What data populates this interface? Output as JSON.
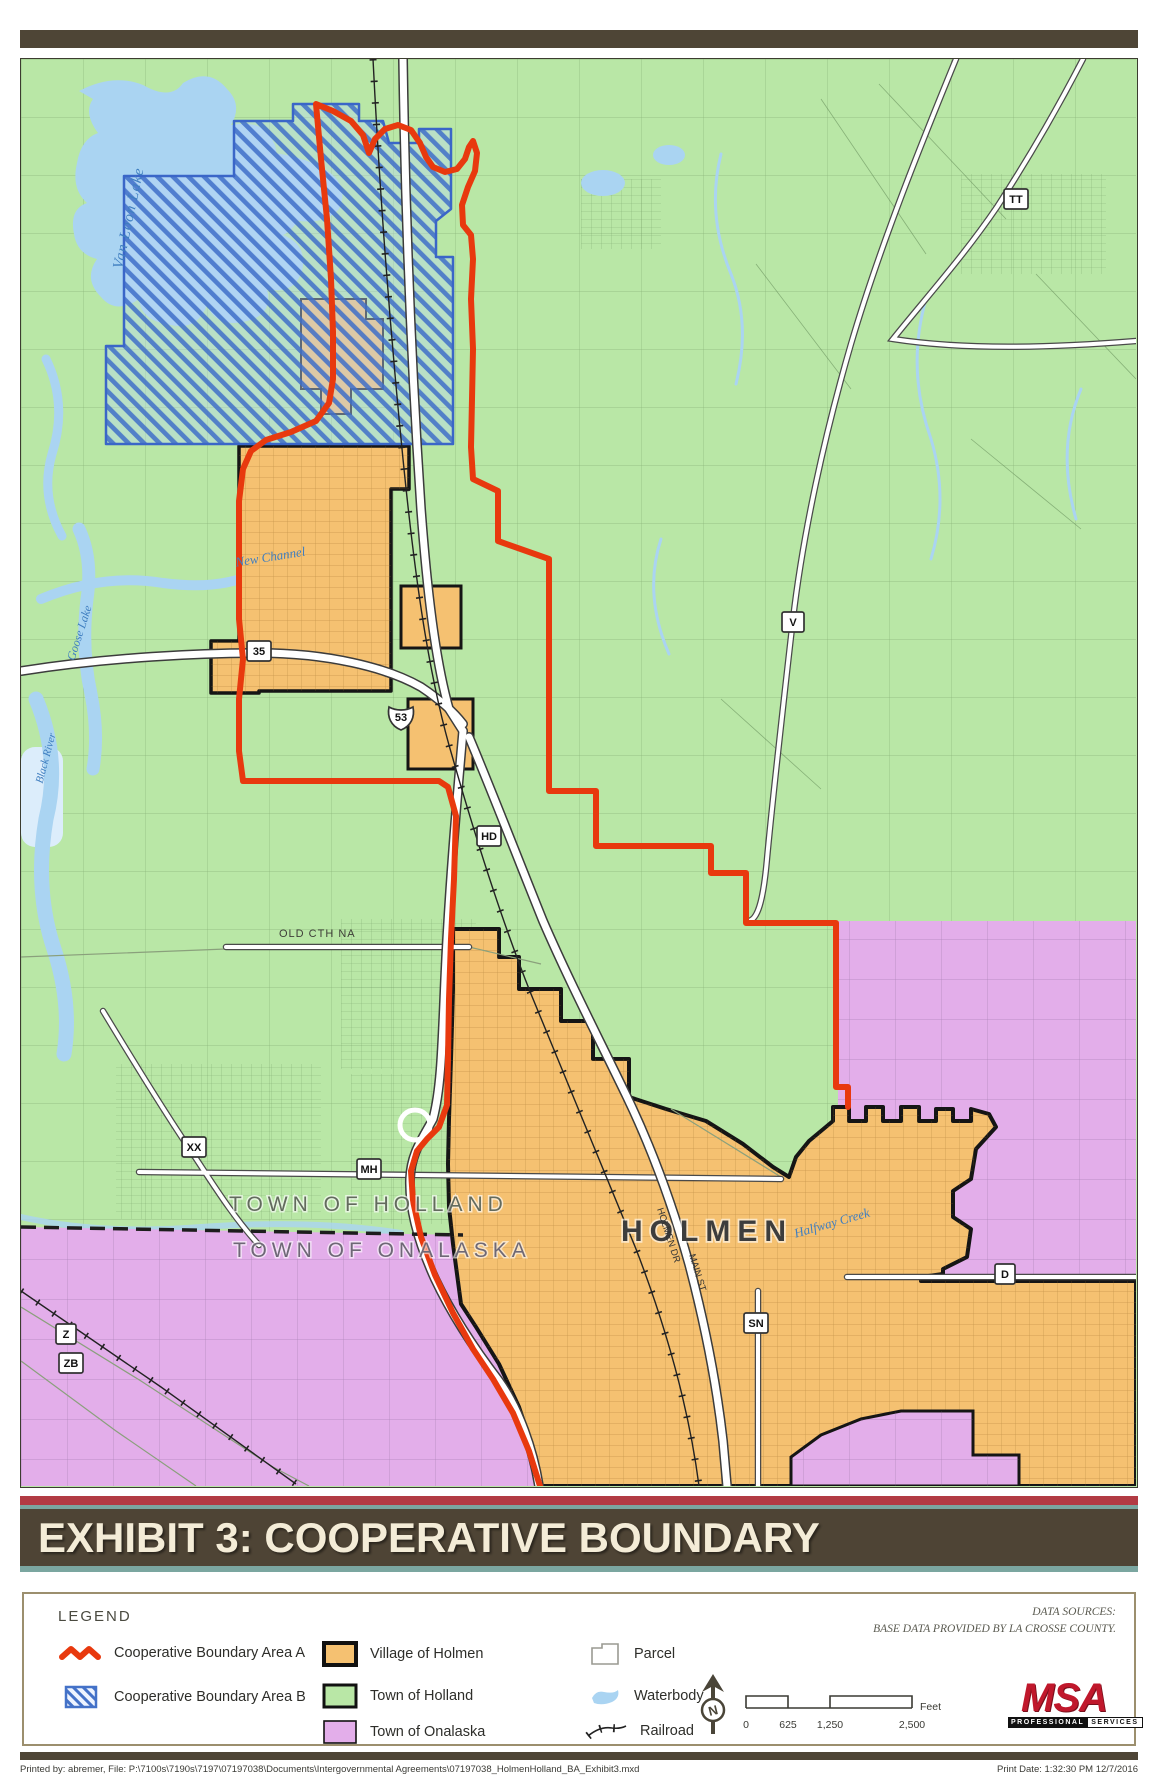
{
  "title": "EXHIBIT 3: COOPERATIVE BOUNDARY",
  "map": {
    "city_label": "HOLMEN",
    "town_labels": [
      "TOWN OF HOLLAND",
      "TOWN OF ONALASKA"
    ],
    "water_labels": [
      "Van Loon Lake",
      "Goose Lake",
      "Black River",
      "New Channel",
      "Halfway Creek"
    ],
    "street_labels": [
      "OLD CTH NA",
      "HOLMEN DR",
      "MAIN ST"
    ],
    "shields": [
      "35",
      "53",
      "HD",
      "V",
      "TT",
      "XX",
      "MH",
      "D",
      "SN",
      "Z",
      "ZB"
    ]
  },
  "legend": {
    "heading": "LEGEND",
    "items": {
      "area_a": "Cooperative Boundary Area A",
      "area_b": "Cooperative Boundary Area B",
      "holmen": "Village of Holmen",
      "holland": "Town of Holland",
      "onalaska": "Town of Onalaska",
      "parcel": "Parcel",
      "waterbody": "Waterbody",
      "railroad": "Railroad"
    },
    "data_sources_line1": "DATA SOURCES:",
    "data_sources_line2": "BASE DATA PROVIDED BY LA CROSSE COUNTY.",
    "north_label": "N",
    "scale": {
      "ticks": [
        "0",
        "625",
        "1,250",
        "2,500"
      ],
      "unit": "Feet"
    },
    "logo": {
      "name": "MSA",
      "tagline_left": "PROFESSIONAL",
      "tagline_right": "SERVICES"
    }
  },
  "footer": {
    "left": "Printed by: abremer, File: P:\\7100s\\7190s\\7197\\07197038\\Documents\\Intergovernmental Agreements\\07197038_HolmenHolland_BA_Exhibit3.mxd",
    "right": "Print Date: 1:32:30 PM 12/7/2016"
  },
  "colors": {
    "village_of_holmen": "#F5C171",
    "town_of_holland": "#B9E7A6",
    "town_of_onalaska": "#E3AEEA",
    "waterbody": "#AAD4F2",
    "boundary_area_a": "#E8390E",
    "boundary_area_b": "#4472C8",
    "title_bar": "#4E4435",
    "stripe_red": "#B23B44",
    "stripe_teal": "#7BA6A0"
  }
}
